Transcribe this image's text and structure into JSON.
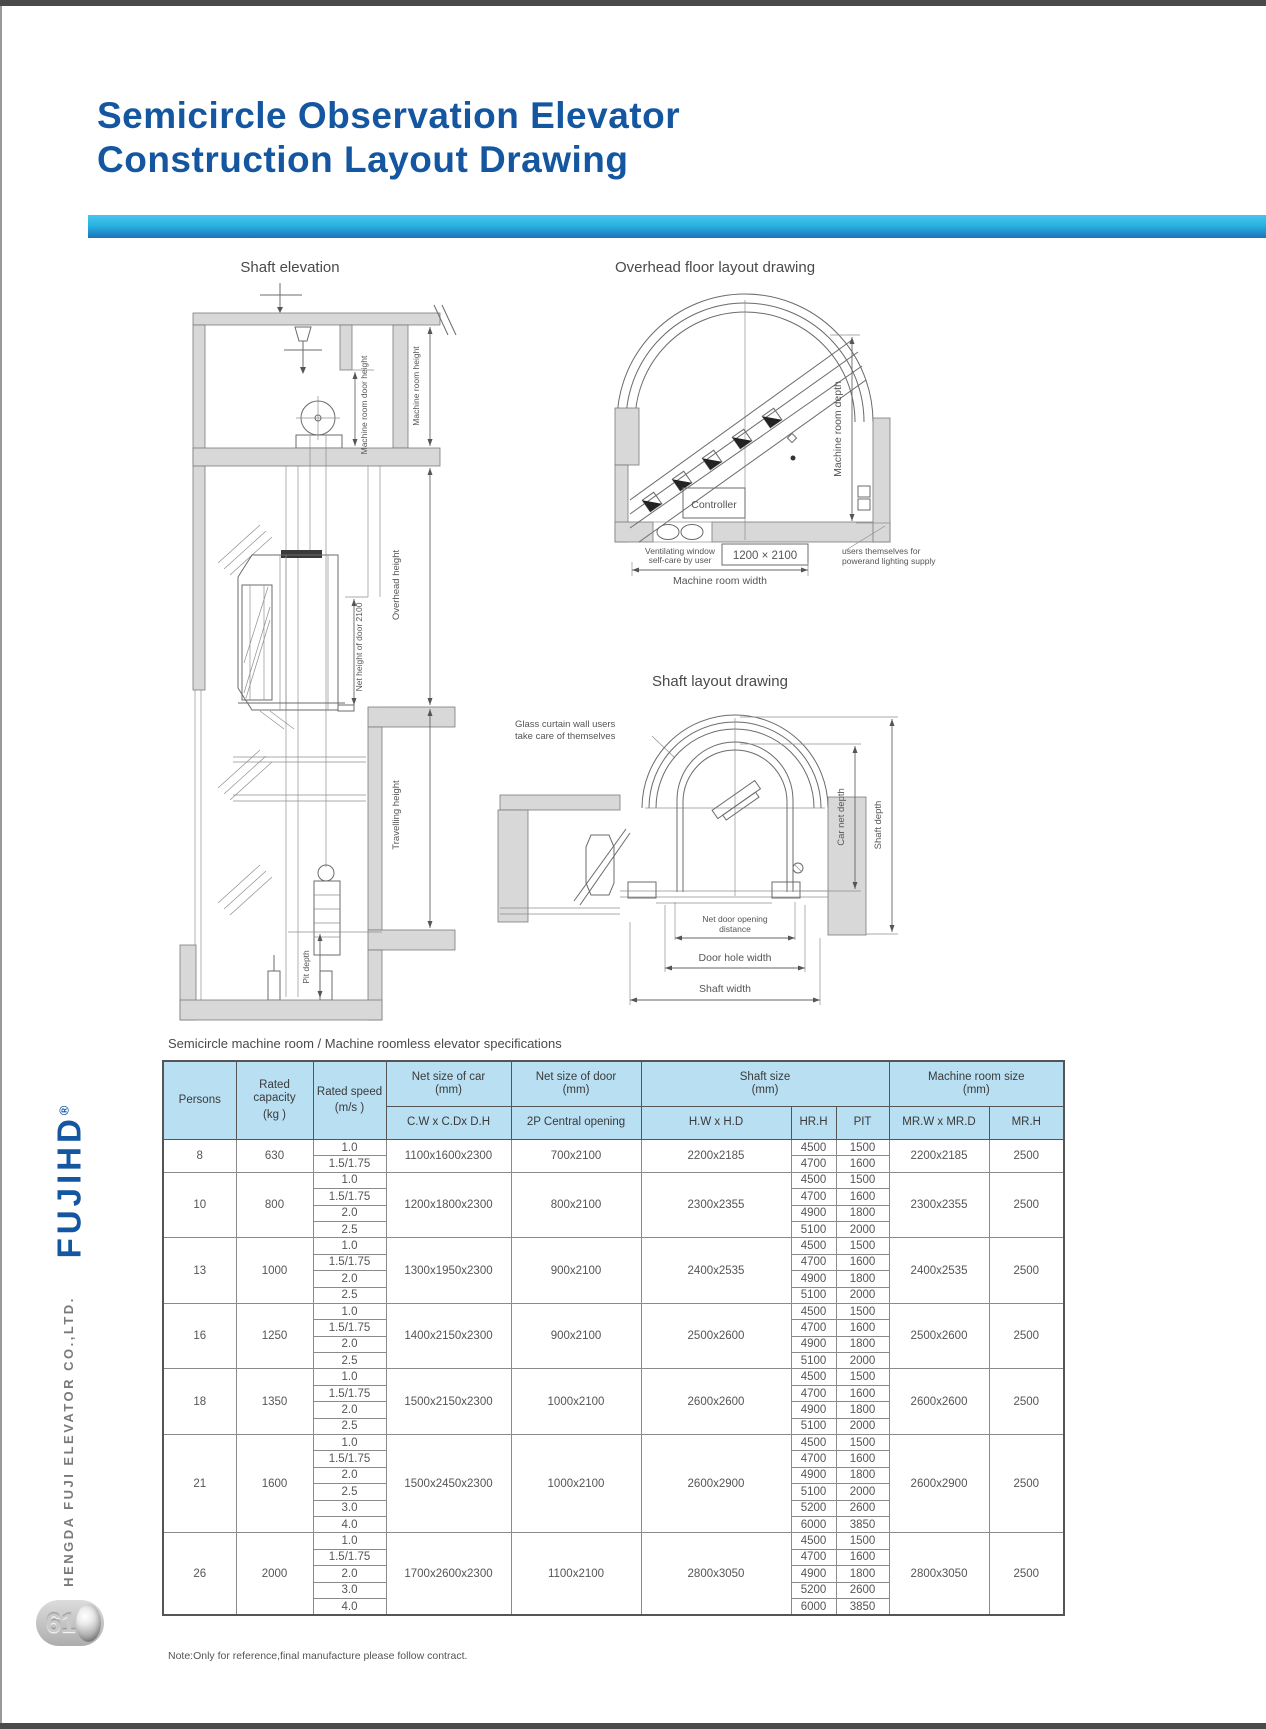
{
  "page": {
    "title_line1": "Semicircle Observation Elevator",
    "title_line2": "Construction Layout Drawing",
    "note": "Note:Only for reference,final manufacture please follow contract.",
    "page_number": "61"
  },
  "brand": {
    "logo": "FUJIHD",
    "registered_mark": "®",
    "company": "HENGDA FUJI ELEVATOR CO.,LTD."
  },
  "colors": {
    "title_blue": "#1456a0",
    "bar_top": "#48c5ee",
    "bar_bottom": "#1b74ba",
    "table_header_bg": "#b9dff2"
  },
  "drawings": {
    "shaft_elevation": {
      "title": "Shaft elevation",
      "labels": {
        "machine_room_door_height": "Machine room door height",
        "machine_room_height": "Machine room height",
        "overhead_height": "Overhead height",
        "net_door_height": "Net height of door 2100",
        "travelling_height": "Travelling height",
        "pit_depth": "Pit depth"
      }
    },
    "overhead_layout": {
      "title": "Overhead floor layout drawing",
      "labels": {
        "controller": "Controller",
        "machine_room_depth": "Machine room depth",
        "ventilating_window_l1": "Ventilating window",
        "ventilating_window_l2": "self-care by user",
        "vent_size": "1200 × 2100",
        "machine_room_width": "Machine room width",
        "power_note_l1": "users themselves for",
        "power_note_l2": "powerand lighting supply"
      }
    },
    "shaft_layout": {
      "title": "Shaft layout drawing",
      "labels": {
        "glass_note_l1": "Glass curtain wall users",
        "glass_note_l2": "take care of themselves",
        "car_net_depth": "Car net depth",
        "shaft_depth": "Shaft depth",
        "net_door_l1": "Net door opening",
        "net_door_l2": "distance",
        "door_hole_width": "Door hole width",
        "shaft_width": "Shaft width"
      }
    }
  },
  "table": {
    "caption": "Semicircle machine room / Machine roomless elevator specifications",
    "headers": {
      "persons": "Persons",
      "rated_capacity": "Rated capacity",
      "rated_capacity_unit": "(kg )",
      "rated_speed": "Rated speed",
      "rated_speed_unit": "(m/s )",
      "net_car": "Net size of car",
      "net_car_unit": "(mm)",
      "net_car_sub": "C.W x C.Dx D.H",
      "net_door": "Net size of door",
      "net_door_unit": "(mm)",
      "net_door_sub": "2P Central opening",
      "shaft_size": "Shaft size",
      "shaft_size_unit": "(mm)",
      "shaft_hw": "H.W x H.D",
      "hrh": "HR.H",
      "pit": "PIT",
      "machine_room": "Machine room size",
      "machine_room_unit": "(mm)",
      "mrw": "MR.W x MR.D",
      "mrh": "MR.H"
    },
    "groups": [
      {
        "persons": "8",
        "capacity": "630",
        "car": "1100x1600x2300",
        "door": "700x2100",
        "shaft": "2200x2185",
        "mr": "2200x2185",
        "mrh": "2500",
        "rows": [
          {
            "speed": "1.0",
            "hrh": "4500",
            "pit": "1500"
          },
          {
            "speed": "1.5/1.75",
            "hrh": "4700",
            "pit": "1600"
          }
        ]
      },
      {
        "persons": "10",
        "capacity": "800",
        "car": "1200x1800x2300",
        "door": "800x2100",
        "shaft": "2300x2355",
        "mr": "2300x2355",
        "mrh": "2500",
        "rows": [
          {
            "speed": "1.0",
            "hrh": "4500",
            "pit": "1500"
          },
          {
            "speed": "1.5/1.75",
            "hrh": "4700",
            "pit": "1600"
          },
          {
            "speed": "2.0",
            "hrh": "4900",
            "pit": "1800"
          },
          {
            "speed": "2.5",
            "hrh": "5100",
            "pit": "2000"
          }
        ]
      },
      {
        "persons": "13",
        "capacity": "1000",
        "car": "1300x1950x2300",
        "door": "900x2100",
        "shaft": "2400x2535",
        "mr": "2400x2535",
        "mrh": "2500",
        "rows": [
          {
            "speed": "1.0",
            "hrh": "4500",
            "pit": "1500"
          },
          {
            "speed": "1.5/1.75",
            "hrh": "4700",
            "pit": "1600"
          },
          {
            "speed": "2.0",
            "hrh": "4900",
            "pit": "1800"
          },
          {
            "speed": "2.5",
            "hrh": "5100",
            "pit": "2000"
          }
        ]
      },
      {
        "persons": "16",
        "capacity": "1250",
        "car": "1400x2150x2300",
        "door": "900x2100",
        "shaft": "2500x2600",
        "mr": "2500x2600",
        "mrh": "2500",
        "rows": [
          {
            "speed": "1.0",
            "hrh": "4500",
            "pit": "1500"
          },
          {
            "speed": "1.5/1.75",
            "hrh": "4700",
            "pit": "1600"
          },
          {
            "speed": "2.0",
            "hrh": "4900",
            "pit": "1800"
          },
          {
            "speed": "2.5",
            "hrh": "5100",
            "pit": "2000"
          }
        ]
      },
      {
        "persons": "18",
        "capacity": "1350",
        "car": "1500x2150x2300",
        "door": "1000x2100",
        "shaft": "2600x2600",
        "mr": "2600x2600",
        "mrh": "2500",
        "rows": [
          {
            "speed": "1.0",
            "hrh": "4500",
            "pit": "1500"
          },
          {
            "speed": "1.5/1.75",
            "hrh": "4700",
            "pit": "1600"
          },
          {
            "speed": "2.0",
            "hrh": "4900",
            "pit": "1800"
          },
          {
            "speed": "2.5",
            "hrh": "5100",
            "pit": "2000"
          }
        ]
      },
      {
        "persons": "21",
        "capacity": "1600",
        "car": "1500x2450x2300",
        "door": "1000x2100",
        "shaft": "2600x2900",
        "mr": "2600x2900",
        "mrh": "2500",
        "rows": [
          {
            "speed": "1.0",
            "hrh": "4500",
            "pit": "1500"
          },
          {
            "speed": "1.5/1.75",
            "hrh": "4700",
            "pit": "1600"
          },
          {
            "speed": "2.0",
            "hrh": "4900",
            "pit": "1800"
          },
          {
            "speed": "2.5",
            "hrh": "5100",
            "pit": "2000"
          },
          {
            "speed": "3.0",
            "hrh": "5200",
            "pit": "2600"
          },
          {
            "speed": "4.0",
            "hrh": "6000",
            "pit": "3850"
          }
        ]
      },
      {
        "persons": "26",
        "capacity": "2000",
        "car": "1700x2600x2300",
        "door": "1100x2100",
        "shaft": "2800x3050",
        "mr": "2800x3050",
        "mrh": "2500",
        "rows": [
          {
            "speed": "1.0",
            "hrh": "4500",
            "pit": "1500"
          },
          {
            "speed": "1.5/1.75",
            "hrh": "4700",
            "pit": "1600"
          },
          {
            "speed": "2.0",
            "hrh": "4900",
            "pit": "1800"
          },
          {
            "speed": "3.0",
            "hrh": "5200",
            "pit": "2600"
          },
          {
            "speed": "4.0",
            "hrh": "6000",
            "pit": "3850"
          }
        ]
      }
    ]
  }
}
